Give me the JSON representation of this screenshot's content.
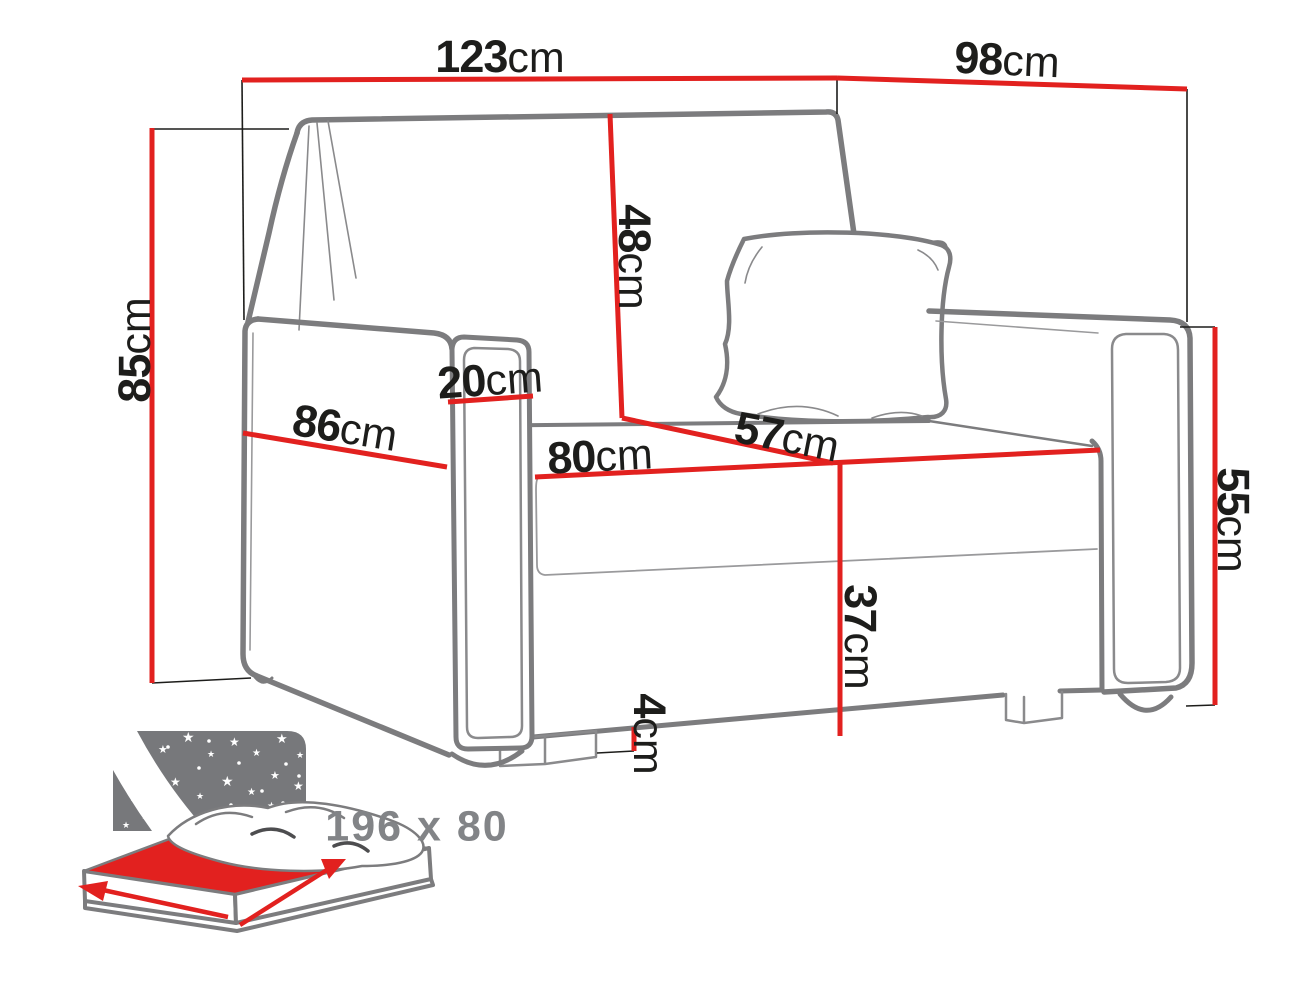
{
  "diagram": {
    "type": "sofa-bed dimension drawing",
    "unit_system": "metric"
  },
  "colors": {
    "dimension_red": "#e2211f",
    "outline_gray": "#7c7c7e",
    "label_black": "#1d1d1b",
    "bed_text_gray": "#828487",
    "bed_panel_gray": "#77787b",
    "bed_mattress_red": "#e2211f",
    "background": "#ffffff"
  },
  "dimensions": [
    {
      "id": "total-width",
      "value": "123",
      "unit": "cm"
    },
    {
      "id": "total-depth",
      "value": "98",
      "unit": "cm"
    },
    {
      "id": "backrest-height",
      "value": "48",
      "unit": "cm"
    },
    {
      "id": "total-height",
      "value": "85",
      "unit": "cm"
    },
    {
      "id": "armrest-width",
      "value": "20",
      "unit": "cm"
    },
    {
      "id": "side-depth",
      "value": "86",
      "unit": "cm"
    },
    {
      "id": "seat-width",
      "value": "80",
      "unit": "cm"
    },
    {
      "id": "seat-depth",
      "value": "57",
      "unit": "cm"
    },
    {
      "id": "seat-height",
      "value": "37",
      "unit": "cm"
    },
    {
      "id": "armrest-height",
      "value": "55",
      "unit": "cm"
    },
    {
      "id": "leg-height",
      "value": "4",
      "unit": "cm"
    }
  ],
  "sleeping_area": {
    "size_label": "196 x 80"
  }
}
